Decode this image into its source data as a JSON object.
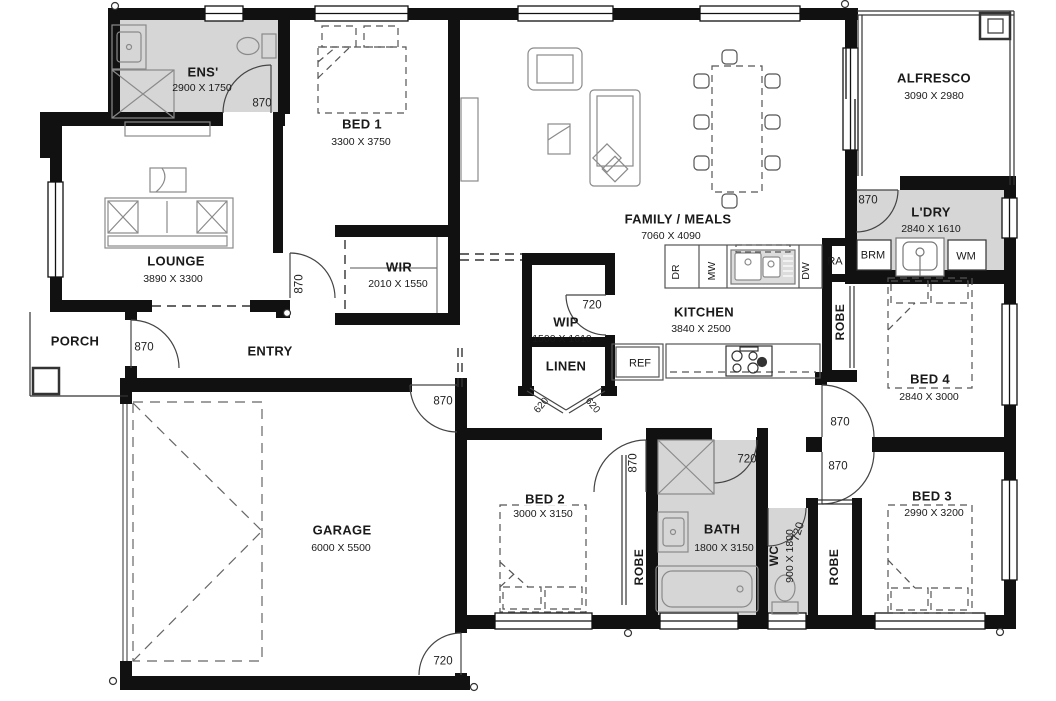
{
  "plan": {
    "rooms": [
      {
        "name": "ENS'",
        "dims": "2900 X 1750"
      },
      {
        "name": "BED 1",
        "dims": "3300 X 3750"
      },
      {
        "name": "FAMILY / MEALS",
        "dims": "7060 X 4090"
      },
      {
        "name": "ALFRESCO",
        "dims": "3090 X 2980"
      },
      {
        "name": "L'DRY",
        "dims": "2840 X 1610"
      },
      {
        "name": "LOUNGE",
        "dims": "3890 X 3300"
      },
      {
        "name": "WIR",
        "dims": "2010 X 1550"
      },
      {
        "name": "PORCH",
        "dims": ""
      },
      {
        "name": "ENTRY",
        "dims": ""
      },
      {
        "name": "WIP",
        "dims": "1500 X 1610"
      },
      {
        "name": "KITCHEN",
        "dims": "3840 X 2500"
      },
      {
        "name": "LINEN",
        "dims": ""
      },
      {
        "name": "GARAGE",
        "dims": "6000 X 5500"
      },
      {
        "name": "BED 2",
        "dims": "3000 X 3150"
      },
      {
        "name": "BATH",
        "dims": "1800 X 3150"
      },
      {
        "name": "WC",
        "dims": "900 X 1800"
      },
      {
        "name": "BED 3",
        "dims": "2990 X 3200"
      },
      {
        "name": "BED 4",
        "dims": "2840 X 3000"
      }
    ],
    "fixtures": {
      "ref": "REF",
      "ra": "RA",
      "brm": "BRM",
      "wm": "WM",
      "dr": "DR",
      "mw": "MW",
      "dw": "DW",
      "robe": "ROBE"
    },
    "door_widths": {
      "d870": "870",
      "d720": "720",
      "d620": "620"
    },
    "colors": {
      "wall": "#111111",
      "wet_area_fill": "#d6d6d6",
      "furniture": "#8a8a8a"
    }
  }
}
